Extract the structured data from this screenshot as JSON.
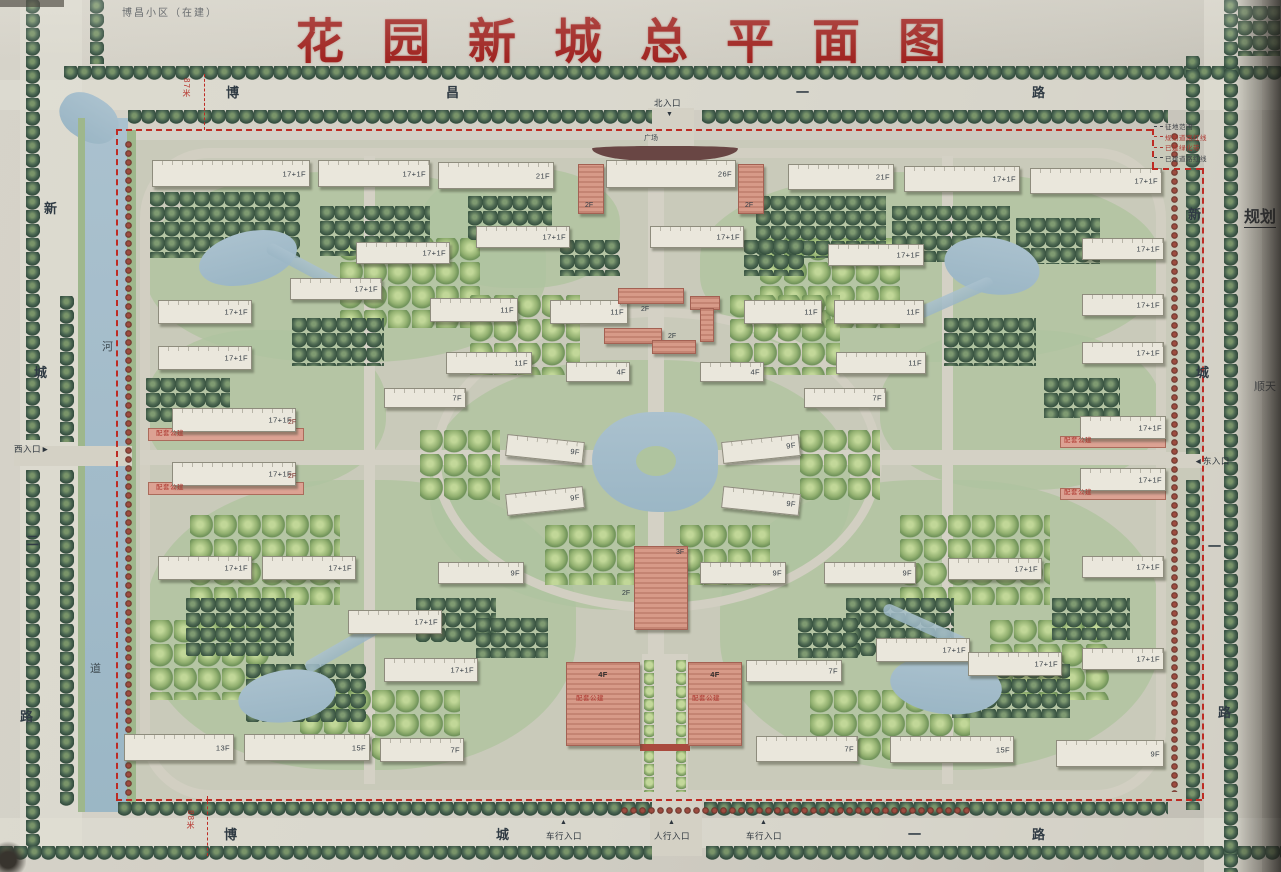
{
  "title": {
    "text": "花园新城总平面图",
    "color": "#a8201d"
  },
  "corner_note": "博昌小区（在建）",
  "legend": [
    {
      "text": "征地范围",
      "color": "#3c4046"
    },
    {
      "text": "规划道路红线",
      "color": "#b5322a"
    },
    {
      "text": "已建绿化带",
      "color": "#b5322a"
    },
    {
      "text": "已建道路红线",
      "color": "#3c4046"
    }
  ],
  "side_texts": [
    {
      "text": "规划",
      "x": 1244,
      "y": 203,
      "size": 16,
      "bold": true,
      "underline": true,
      "color": "#2e3338"
    },
    {
      "text": "顺天",
      "x": 1254,
      "y": 378,
      "size": 11,
      "bold": false,
      "underline": false,
      "color": "#4a5056"
    }
  ],
  "dim_marks": [
    {
      "text": "87米",
      "x": 182,
      "y": 78
    },
    {
      "text": "88米",
      "x": 186,
      "y": 810
    }
  ],
  "road_labels": [
    {
      "text": "博",
      "x": 226,
      "y": 86,
      "size": 13
    },
    {
      "text": "昌",
      "x": 446,
      "y": 86,
      "size": 13
    },
    {
      "text": "一",
      "x": 796,
      "y": 86,
      "size": 13
    },
    {
      "text": "路",
      "x": 1032,
      "y": 86,
      "size": 13
    },
    {
      "text": "博",
      "x": 224,
      "y": 828,
      "size": 13
    },
    {
      "text": "城",
      "x": 496,
      "y": 828,
      "size": 13
    },
    {
      "text": "一",
      "x": 908,
      "y": 828,
      "size": 13
    },
    {
      "text": "路",
      "x": 1032,
      "y": 828,
      "size": 13
    },
    {
      "text": "新",
      "x": 44,
      "y": 202,
      "size": 13
    },
    {
      "text": "城",
      "x": 34,
      "y": 366,
      "size": 13
    },
    {
      "text": "二",
      "x": 26,
      "y": 534,
      "size": 13
    },
    {
      "text": "路",
      "x": 20,
      "y": 710,
      "size": 13
    },
    {
      "text": "新",
      "x": 1188,
      "y": 208,
      "size": 13
    },
    {
      "text": "城",
      "x": 1196,
      "y": 366,
      "size": 13
    },
    {
      "text": "一",
      "x": 1208,
      "y": 540,
      "size": 13
    },
    {
      "text": "路",
      "x": 1218,
      "y": 706,
      "size": 13
    }
  ],
  "entrances": [
    {
      "text": "北入口",
      "x": 654,
      "y": 99,
      "arrow": "▼",
      "ax": 666,
      "ay": 111
    },
    {
      "text": "西入口►",
      "x": 14,
      "y": 445
    },
    {
      "text": "◄东入口",
      "x": 1194,
      "y": 457
    },
    {
      "text": "车行入口",
      "x": 546,
      "y": 832,
      "arrow": "▲",
      "ax": 560,
      "ay": 819
    },
    {
      "text": "人行入口",
      "x": 654,
      "y": 832,
      "arrow": "▲",
      "ax": 668,
      "ay": 819
    },
    {
      "text": "车行入口",
      "x": 746,
      "y": 832,
      "arrow": "▲",
      "ax": 760,
      "ay": 819
    }
  ],
  "river_chars": [
    {
      "text": "河",
      "x": 102,
      "y": 342
    },
    {
      "text": "道",
      "x": 90,
      "y": 664
    }
  ],
  "buildings": [
    {
      "x": 152,
      "y": 160,
      "w": 158,
      "h": 27,
      "label": "17+1F"
    },
    {
      "x": 318,
      "y": 160,
      "w": 112,
      "h": 27,
      "label": "17+1F"
    },
    {
      "x": 438,
      "y": 162,
      "w": 116,
      "h": 27,
      "label": "21F"
    },
    {
      "x": 578,
      "y": 164,
      "w": 26,
      "h": 50,
      "type": "pink"
    },
    {
      "x": 606,
      "y": 160,
      "w": 130,
      "h": 28,
      "label": "26F"
    },
    {
      "x": 738,
      "y": 164,
      "w": 26,
      "h": 50,
      "type": "pink"
    },
    {
      "x": 788,
      "y": 164,
      "w": 106,
      "h": 26,
      "label": "21F"
    },
    {
      "x": 904,
      "y": 166,
      "w": 116,
      "h": 26,
      "label": "17+1F"
    },
    {
      "x": 1030,
      "y": 168,
      "w": 132,
      "h": 26,
      "label": "17+1F"
    },
    {
      "x": 356,
      "y": 242,
      "w": 94,
      "h": 22,
      "label": "17+1F"
    },
    {
      "x": 476,
      "y": 226,
      "w": 94,
      "h": 22,
      "label": "17+1F"
    },
    {
      "x": 650,
      "y": 226,
      "w": 94,
      "h": 22,
      "label": "17+1F"
    },
    {
      "x": 828,
      "y": 244,
      "w": 96,
      "h": 22,
      "label": "17+1F"
    },
    {
      "x": 1082,
      "y": 238,
      "w": 82,
      "h": 22,
      "label": "17+1F"
    },
    {
      "x": 290,
      "y": 278,
      "w": 92,
      "h": 22,
      "label": "17+1F"
    },
    {
      "x": 158,
      "y": 300,
      "w": 94,
      "h": 24,
      "label": "17+1F"
    },
    {
      "x": 430,
      "y": 298,
      "w": 88,
      "h": 24,
      "label": "11F"
    },
    {
      "x": 550,
      "y": 300,
      "w": 78,
      "h": 24,
      "label": "11F"
    },
    {
      "x": 744,
      "y": 300,
      "w": 78,
      "h": 24,
      "label": "11F"
    },
    {
      "x": 834,
      "y": 300,
      "w": 90,
      "h": 24,
      "label": "11F"
    },
    {
      "x": 1082,
      "y": 294,
      "w": 82,
      "h": 22,
      "label": "17+1F"
    },
    {
      "x": 158,
      "y": 346,
      "w": 94,
      "h": 24,
      "label": "17+1F"
    },
    {
      "x": 446,
      "y": 352,
      "w": 86,
      "h": 22,
      "label": "11F"
    },
    {
      "x": 836,
      "y": 352,
      "w": 90,
      "h": 22,
      "label": "11F"
    },
    {
      "x": 1082,
      "y": 342,
      "w": 82,
      "h": 22,
      "label": "17+1F"
    },
    {
      "x": 384,
      "y": 388,
      "w": 82,
      "h": 20,
      "label": "7F"
    },
    {
      "x": 566,
      "y": 362,
      "w": 64,
      "h": 20,
      "label": "4F"
    },
    {
      "x": 700,
      "y": 362,
      "w": 64,
      "h": 20,
      "label": "4F"
    },
    {
      "x": 804,
      "y": 388,
      "w": 82,
      "h": 20,
      "label": "7F"
    },
    {
      "x": 506,
      "y": 438,
      "w": 78,
      "h": 22,
      "label": "9F",
      "rot": 6
    },
    {
      "x": 506,
      "y": 490,
      "w": 78,
      "h": 22,
      "label": "9F",
      "rot": -6
    },
    {
      "x": 722,
      "y": 438,
      "w": 78,
      "h": 22,
      "label": "9F",
      "rot": -6
    },
    {
      "x": 722,
      "y": 490,
      "w": 78,
      "h": 22,
      "label": "9F",
      "rot": 6
    },
    {
      "x": 172,
      "y": 408,
      "w": 124,
      "h": 24,
      "label": "17+1F"
    },
    {
      "x": 172,
      "y": 462,
      "w": 124,
      "h": 24,
      "label": "17+1F"
    },
    {
      "x": 1080,
      "y": 416,
      "w": 86,
      "h": 23,
      "label": "17+1F"
    },
    {
      "x": 1080,
      "y": 468,
      "w": 86,
      "h": 23,
      "label": "17+1F"
    },
    {
      "x": 158,
      "y": 556,
      "w": 94,
      "h": 24,
      "label": "17+1F"
    },
    {
      "x": 262,
      "y": 556,
      "w": 94,
      "h": 24,
      "label": "17+1F"
    },
    {
      "x": 438,
      "y": 562,
      "w": 86,
      "h": 22,
      "label": "9F"
    },
    {
      "x": 700,
      "y": 562,
      "w": 86,
      "h": 22,
      "label": "9F"
    },
    {
      "x": 824,
      "y": 562,
      "w": 92,
      "h": 22,
      "label": "9F"
    },
    {
      "x": 948,
      "y": 558,
      "w": 94,
      "h": 22,
      "label": "17+1F"
    },
    {
      "x": 1082,
      "y": 556,
      "w": 82,
      "h": 22,
      "label": "17+1F"
    },
    {
      "x": 348,
      "y": 610,
      "w": 94,
      "h": 24,
      "label": "17+1F"
    },
    {
      "x": 384,
      "y": 658,
      "w": 94,
      "h": 24,
      "label": "17+1F"
    },
    {
      "x": 876,
      "y": 638,
      "w": 94,
      "h": 24,
      "label": "17+1F"
    },
    {
      "x": 968,
      "y": 652,
      "w": 94,
      "h": 24,
      "label": "17+1F"
    },
    {
      "x": 1082,
      "y": 648,
      "w": 82,
      "h": 22,
      "label": "17+1F"
    },
    {
      "x": 746,
      "y": 660,
      "w": 96,
      "h": 22,
      "label": "7F"
    },
    {
      "x": 566,
      "y": 662,
      "w": 74,
      "h": 84,
      "label": "4F",
      "type": "pink"
    },
    {
      "x": 688,
      "y": 662,
      "w": 54,
      "h": 84,
      "label": "4F",
      "type": "pink"
    },
    {
      "x": 634,
      "y": 546,
      "w": 54,
      "h": 84,
      "type": "pink"
    },
    {
      "x": 618,
      "y": 288,
      "w": 66,
      "h": 16,
      "type": "pink"
    },
    {
      "x": 690,
      "y": 296,
      "w": 30,
      "h": 14,
      "type": "pink"
    },
    {
      "x": 604,
      "y": 328,
      "w": 58,
      "h": 16,
      "type": "pink"
    },
    {
      "x": 652,
      "y": 340,
      "w": 44,
      "h": 14,
      "type": "pink"
    },
    {
      "x": 700,
      "y": 308,
      "w": 14,
      "h": 34,
      "type": "pink"
    },
    {
      "x": 124,
      "y": 734,
      "w": 110,
      "h": 27,
      "label": "13F"
    },
    {
      "x": 244,
      "y": 734,
      "w": 126,
      "h": 27,
      "label": "15F"
    },
    {
      "x": 380,
      "y": 738,
      "w": 84,
      "h": 24,
      "label": "7F"
    },
    {
      "x": 756,
      "y": 736,
      "w": 102,
      "h": 26,
      "label": "7F"
    },
    {
      "x": 890,
      "y": 736,
      "w": 124,
      "h": 27,
      "label": "15F"
    },
    {
      "x": 1056,
      "y": 740,
      "w": 108,
      "h": 27,
      "label": "9F"
    }
  ],
  "pink_strips": [
    {
      "x": 148,
      "y": 428,
      "w": 156,
      "h": 13
    },
    {
      "x": 148,
      "y": 482,
      "w": 156,
      "h": 13
    },
    {
      "x": 1060,
      "y": 436,
      "w": 106,
      "h": 12
    },
    {
      "x": 1060,
      "y": 488,
      "w": 106,
      "h": 12
    }
  ],
  "public_tags": [
    {
      "text": "配套公建",
      "x": 156,
      "y": 431
    },
    {
      "text": "配套公建",
      "x": 156,
      "y": 485
    },
    {
      "text": "配套公建",
      "x": 1064,
      "y": 438
    },
    {
      "text": "配套公建",
      "x": 1064,
      "y": 490
    },
    {
      "text": "配套公建",
      "x": 576,
      "y": 696
    },
    {
      "text": "配套公建",
      "x": 692,
      "y": 696
    }
  ],
  "small_labels": [
    {
      "text": "广场",
      "x": 644,
      "y": 135,
      "size": 7,
      "color": "#3a444c"
    },
    {
      "text": "2F",
      "x": 585,
      "y": 202,
      "size": 7,
      "color": "#2f3a42"
    },
    {
      "text": "2F",
      "x": 745,
      "y": 202,
      "size": 7,
      "color": "#2f3a42"
    },
    {
      "text": "2F",
      "x": 641,
      "y": 306,
      "size": 7,
      "color": "#2f3a42"
    },
    {
      "text": "2F",
      "x": 668,
      "y": 333,
      "size": 7,
      "color": "#2f3a42"
    },
    {
      "text": "3F",
      "x": 676,
      "y": 549,
      "size": 7,
      "color": "#2f3a42"
    },
    {
      "text": "2F",
      "x": 622,
      "y": 590,
      "size": 7,
      "color": "#2f3a42"
    },
    {
      "text": "2F",
      "x": 288,
      "y": 419,
      "size": 7,
      "color": "#7d2b22"
    },
    {
      "text": "2F",
      "x": 288,
      "y": 473,
      "size": 7,
      "color": "#7d2b22"
    }
  ],
  "colors": {
    "paper": "#d1cec4",
    "water": "#a5c0cf",
    "tree_dark": "#3f5d49",
    "lawn": "#b0c79e",
    "building_pink": "#dd9a86",
    "boundary_red": "#c8271f",
    "title_red": "#a8201d"
  }
}
